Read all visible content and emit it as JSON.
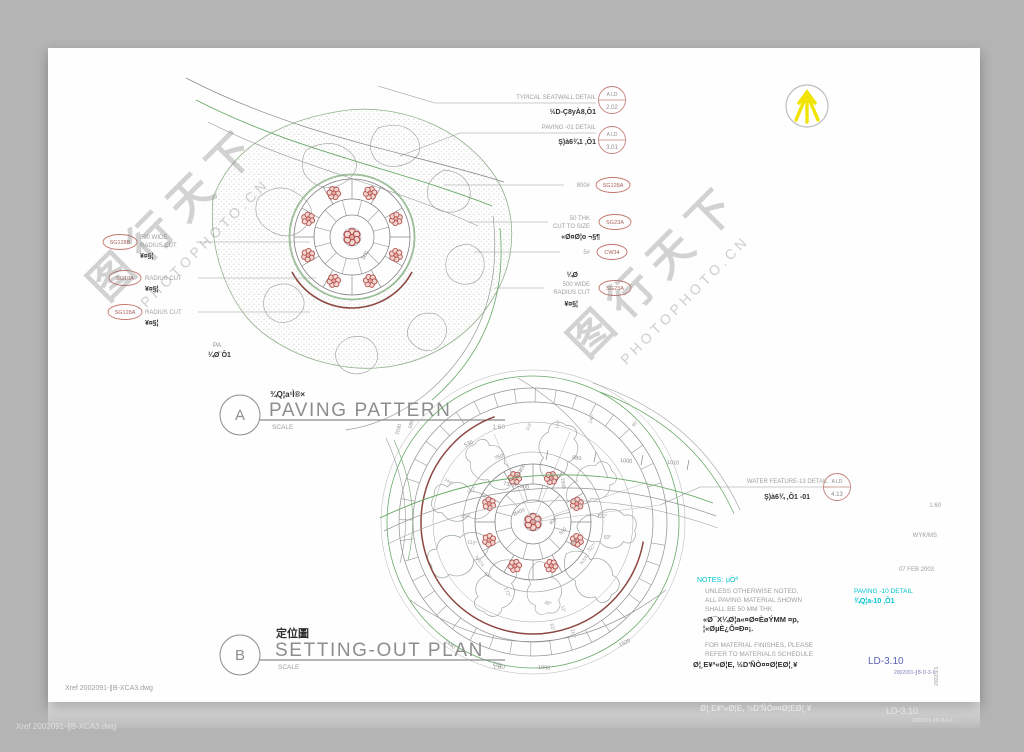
{
  "colors": {
    "paper": "#fefefe",
    "bg": "#b4b4b4",
    "green": "#68a868",
    "dark_red": "#8c4742",
    "flower_red": "#b4504b",
    "tag_red": "#c4766e",
    "cyan": "#00c3cd",
    "blue": "#5b63b4",
    "north_yellow": "#f0e400"
  },
  "watermark": {
    "zh": "图行天下",
    "en": "PHOTOPHOTO.CN"
  },
  "a": {
    "ref_label": "A",
    "title_zh": "¾Q¦a¹Ì®×",
    "title": "PAVING PATTERN",
    "scale_word": "SCALE",
    "scale_val": "1:60",
    "pa": "PA",
    "pa_sub": "¼Ø¨Ô1",
    "dim_500": "500",
    "co_seatwall": "TYPICAL SEATWALL DETAIL",
    "co_seatwall_sub": "½D-Ç8yÀ8‚Ô1",
    "co_seatwall_ref_top": "A  LD",
    "co_seatwall_ref_no": "2.02",
    "co_paving": "PAVING -01 DETAIL",
    "co_paving_sub": "Ş)à6¾1 ‚Ô1",
    "co_paving_ref_top": "A  LD",
    "co_paving_ref_no": "3.01",
    "r1": "800#",
    "r1_tag": "SG128A",
    "r2a": "50 THK",
    "r2b": "CUT TO SIZE",
    "r2_tag": "SG23A",
    "r2_sub": "«Ø¤Ø¦o ¬§¶",
    "r3": "5#",
    "r3_tag": "CW34",
    "r4a": "500 WIDE",
    "r4b": "RADIUS CUT",
    "r4_tag": "SG23A",
    "r4_sup": "¼Ø",
    "r4_sub": "¥¤§¦",
    "l1_tag": "SG128B",
    "l1a": "500 WIDE",
    "l1b": "RADIUS CUT",
    "l1_sub": "¥¤§¦",
    "l2_tag": "SG10A",
    "l2": "RADIUS CUT",
    "l2_sub": "¥¤§¦",
    "l3_tag": "SG128A",
    "l3": "RADIUS CUT",
    "l3_sub": "¥¤§¦"
  },
  "b": {
    "ref_label": "B",
    "title_zh": "定位圖",
    "title": "SETTING-OUT PLAN",
    "scale_word": "SCALE",
    "scale_val": "1:60",
    "co_water": "WATER FEATURE-13 DETAIL",
    "co_water_sub": "Ş)à6¾ ‚Ô1 -01",
    "co_water_ref_top": "A  LD",
    "co_water_ref_no": "4.13",
    "dims": {
      "d530": "530",
      "d750": "750",
      "r5800": "R5800",
      "d980": "980",
      "d1000": "1000",
      "d1010": "1010",
      "d1500": "1500",
      "arc": "73°  R7500",
      "d1030": "1030",
      "d180": "180",
      "d1440": "1440",
      "d720": "720",
      "d1090": "1090",
      "d1520": "1520",
      "dia": "Ø400",
      "d400a": "400",
      "d500": "500",
      "d400b": "400"
    },
    "angles": {
      "a115": "115°",
      "a124": "124°",
      "a140": "140°",
      "a95": "95°",
      "a144": "144°",
      "a137": "137°",
      "a158": "158°",
      "a113": "113°",
      "n374": "N:374",
      "a64": "64°",
      "a172": "172°",
      "a48": "48°",
      "a11": "11°",
      "a63": "63°",
      "a111": "111°",
      "a327": "327°",
      "n542": "N:542",
      "a121": "121°",
      "a83": "83°"
    }
  },
  "notes": {
    "head": "NOTES:",
    "head_sub": "µÒª",
    "l1": "UNLESS OTHERWISE NOTED,",
    "l2": "ALL PAVING MATERIAL SHOWN",
    "l3": "SHALL BE 50 MM THK.",
    "g1": "«Ø¯X¼Ø¦a«¤Ø¤ÈøÝMM  ¤p,",
    "g2": "¦«ØµÈ¿Ô¤Ð¤¡.",
    "l4": "FOR MATERIAL FINISHES, PLEASE",
    "l5": "REFER TO MATERIALS SCHEDULE",
    "g3": "Ø¦¸E¥ª«Ø¦E, ½D'ÑÒ¤¤Ø¦EØ¦¸¥"
  },
  "paving10": {
    "line1": "PAVING -10 DETAIL",
    "line2": "¾Q¦a-10 ‚Ô1"
  },
  "titleblock": {
    "dwg_no": "LD-3.10",
    "file_no": "2002091-∥B-D-3-1",
    "side_no": "2002/9/1",
    "scale": "1:60",
    "drawn": "WYK/MS",
    "date": "07 FEB 2003"
  },
  "xref": "Xref  2002091-∥B-XCA3.dwg",
  "ghost": {
    "g1": "Ø¦¸E¥ª«Ø¦E, ½D'ÑÒ¤¤Ø¦EØ¦¸¥",
    "g2": "LD-3.10",
    "g3": "2002091-∥B-D-3-1",
    "g0": "Xref  2002091-∥B-XCA3.dwg"
  }
}
